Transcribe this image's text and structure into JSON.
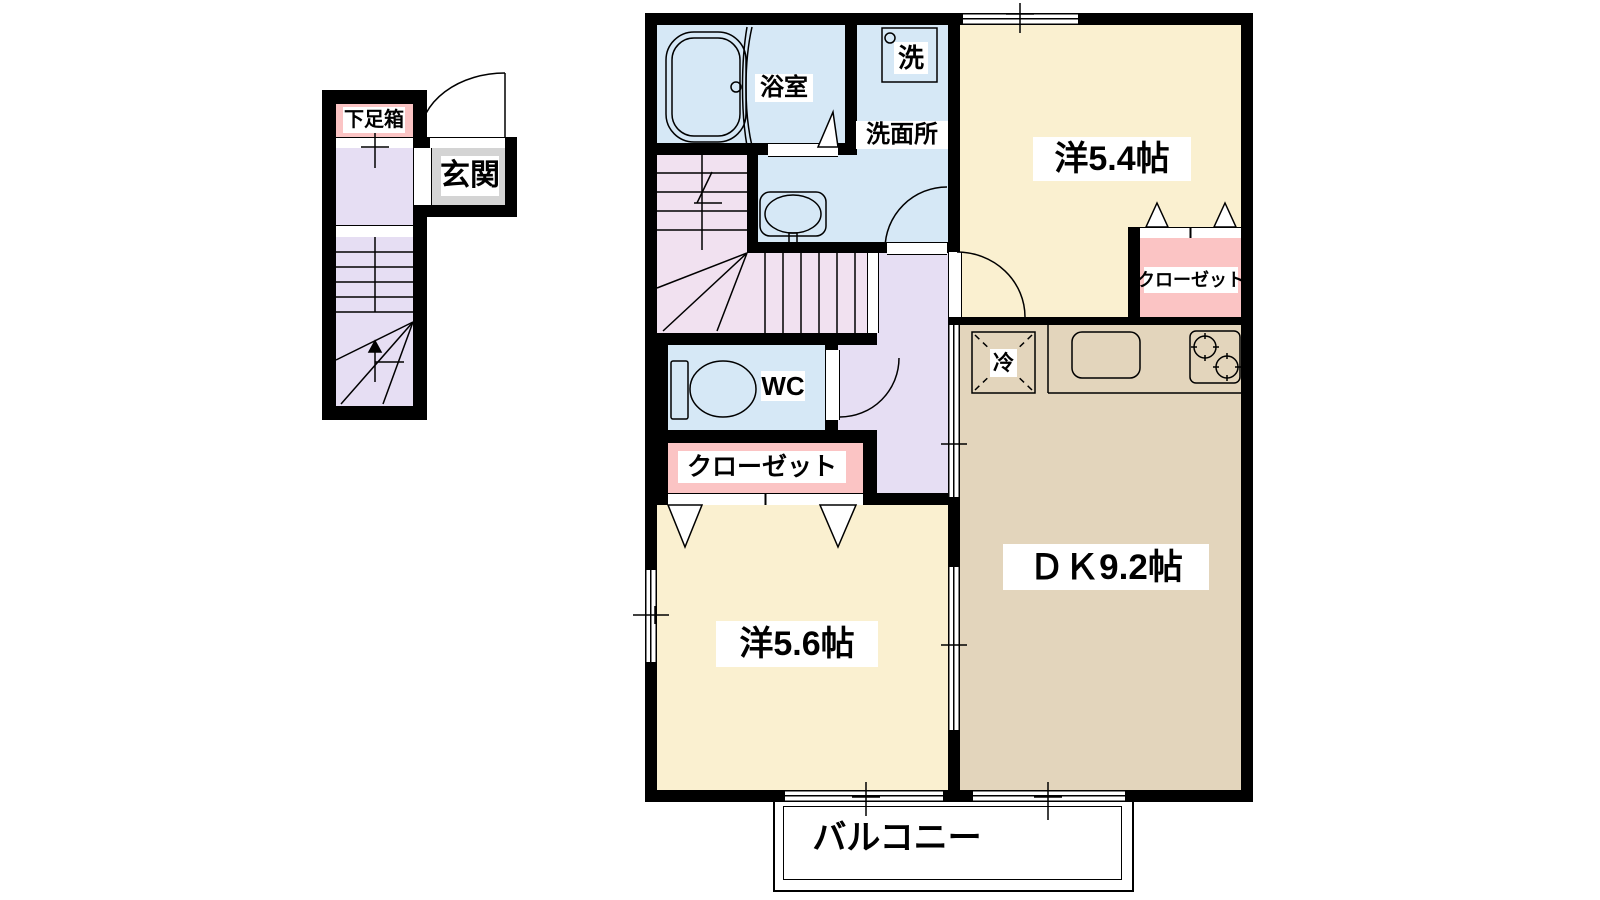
{
  "diagram_type": "apartment-floor-plan",
  "labels": {
    "shoe_box": "下足箱",
    "entrance": "玄関",
    "bathroom": "浴室",
    "washing_machine": "洗",
    "washroom": "洗面所",
    "western_room_54": "洋5.4帖",
    "closet_54": "クローゼット",
    "fridge": "冷",
    "wc": "WC",
    "closet_56": "クローゼット",
    "western_room_56": "洋5.6帖",
    "dining_kitchen": "ＤＫ9.2帖",
    "balcony": "バルコニー"
  },
  "colors": {
    "wall": "#000000",
    "wet_area_blue": "#D6E8F6",
    "room_cream": "#FAF0D0",
    "dk_tan": "#E3D5BC",
    "closet_pink": "#FBC4C4",
    "hall_lavender": "#E6DEF3",
    "stair_pink": "#F1E1F0",
    "entrance_gray": "#D4D4D4"
  }
}
